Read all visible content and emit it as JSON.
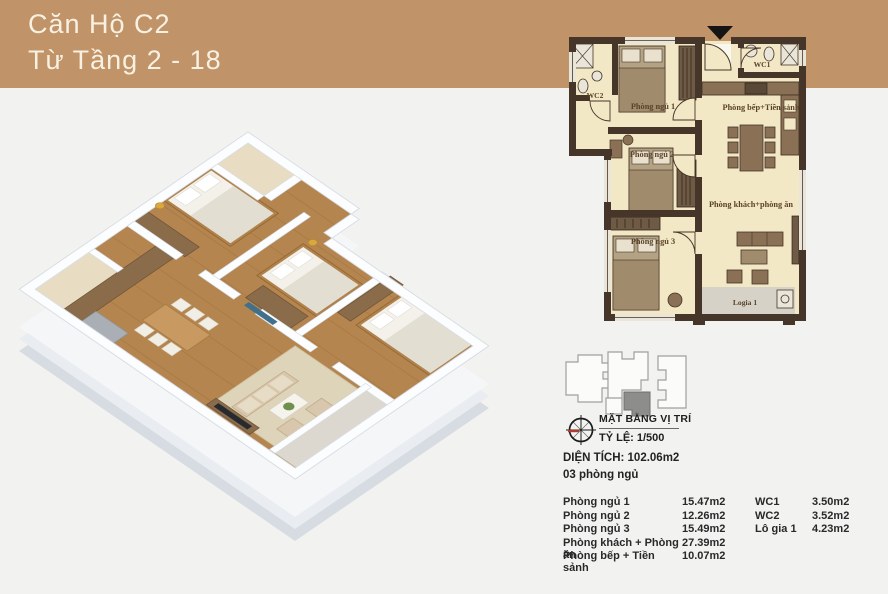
{
  "header": {
    "title_line1": "Căn Hộ C2",
    "title_line2": "Từ Tầng 2 - 18"
  },
  "colors": {
    "banner": "#c09368",
    "plan_wall": "#463629",
    "plan_floor": "#f3e8c5",
    "background": "#f2f2f0",
    "wood_floor": "#b5854f",
    "logia_floor": "#d6d2c8"
  },
  "floor_plan": {
    "labels": {
      "wc1": "WC1",
      "wc2": "WC2",
      "bedroom1": "Phòng ngủ 1",
      "bedroom2": "Phòng ngủ 2",
      "bedroom3": "Phòng ngủ 3",
      "kitchen": "Phòng bếp+Tiền sảnh",
      "living": "Phòng khách+phòng ăn",
      "logia": "Logia 1"
    }
  },
  "location": {
    "title": "MẶT BẰNG VỊ TRÍ",
    "scale": "TỶ LỆ: 1/500"
  },
  "summary": {
    "area": "DIỆN TÍCH: 102.06m2",
    "bedrooms": "03 phòng ngủ"
  },
  "legend": {
    "left": [
      {
        "name": "Phòng ngủ 1",
        "area": "15.47m2"
      },
      {
        "name": "Phòng ngủ 2",
        "area": "12.26m2"
      },
      {
        "name": "Phòng ngủ 3",
        "area": "15.49m2"
      },
      {
        "name": "Phòng khách + Phòng ăn",
        "area": "27.39m2"
      },
      {
        "name": "Phòng bếp + Tiền sảnh",
        "area": "10.07m2"
      }
    ],
    "right": [
      {
        "name": "WC1",
        "area": "3.50m2"
      },
      {
        "name": "WC2",
        "area": "3.52m2"
      },
      {
        "name": "Lô gia 1",
        "area": "4.23m2"
      }
    ]
  }
}
